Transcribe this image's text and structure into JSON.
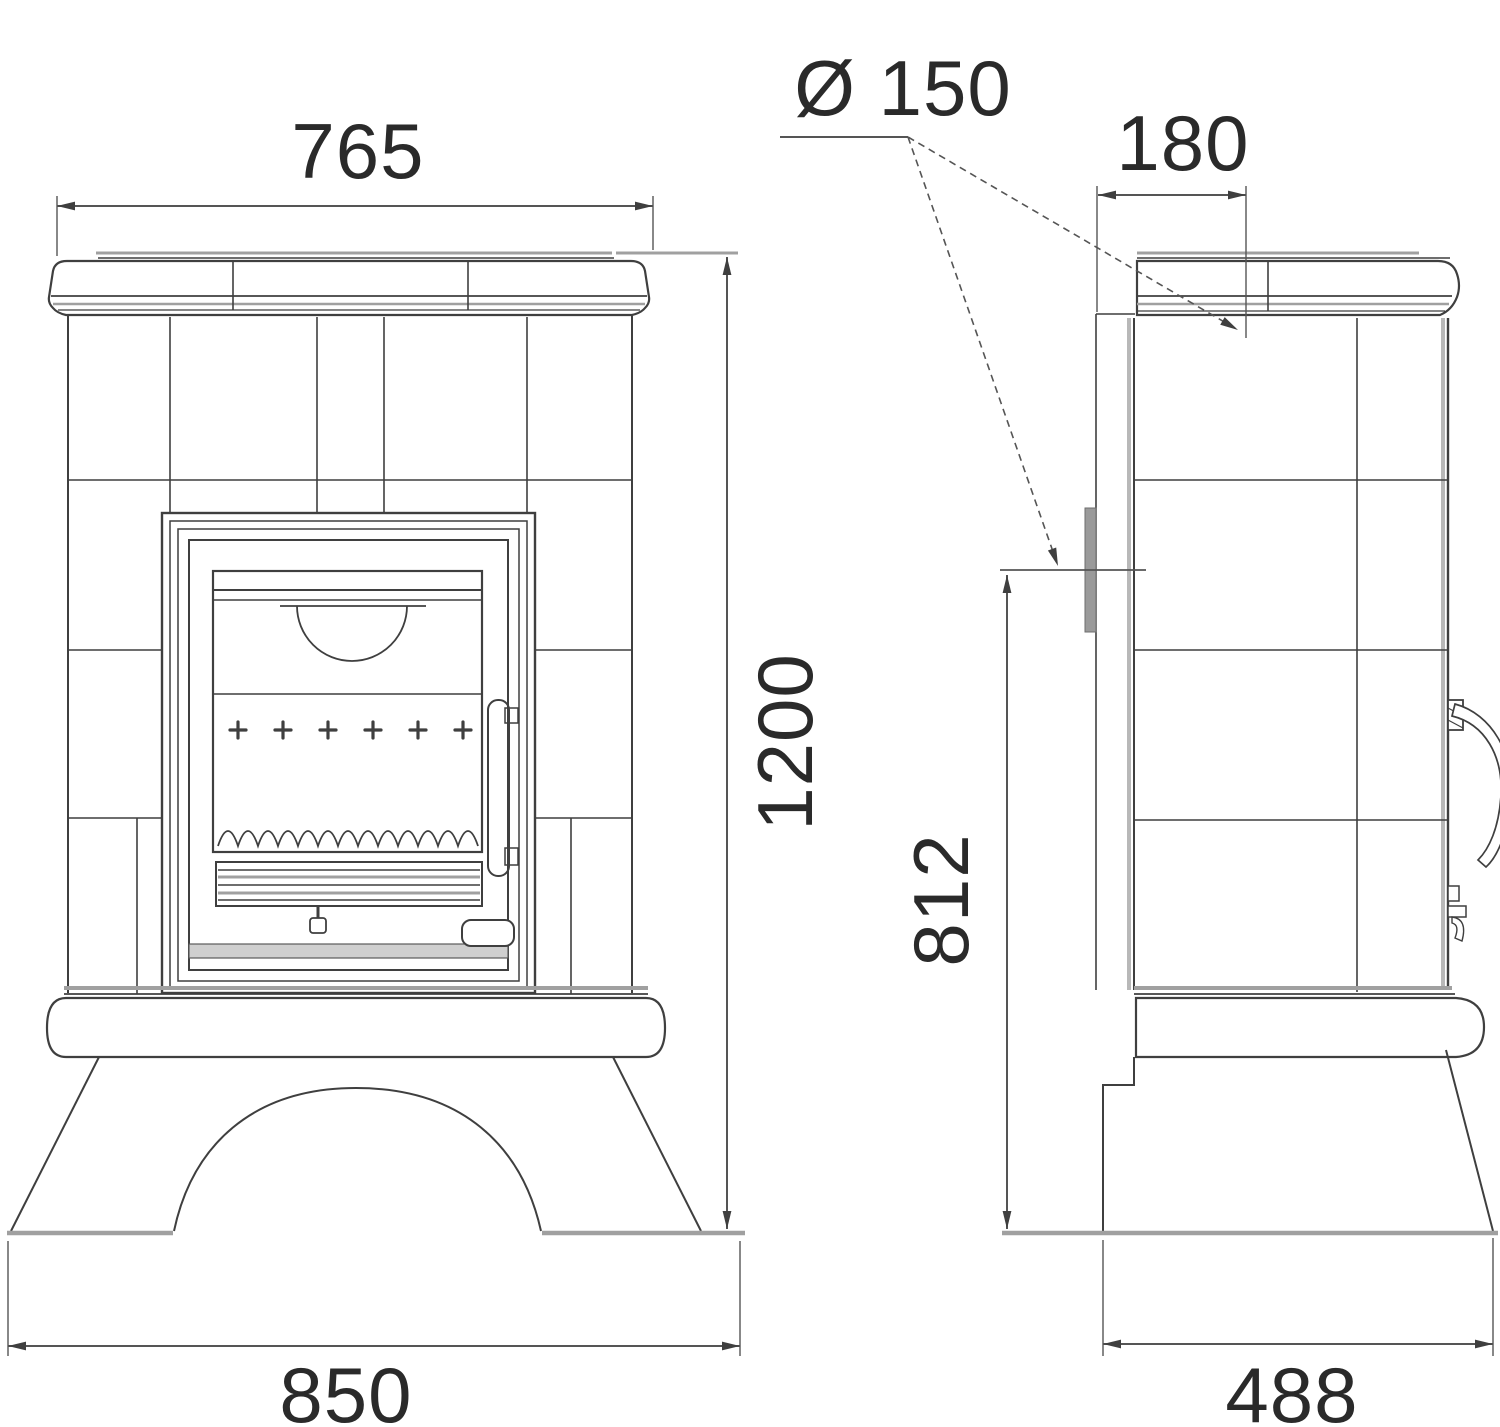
{
  "drawing": {
    "background": "#ffffff",
    "line_color": "#3f3f3f",
    "soft_line_color": "#a0a0a0",
    "dimension_color": "#555555",
    "label_color": "#2a2a2a",
    "labels": {
      "top_width": "765",
      "flue_diameter": "Ø 150",
      "flue_center_offset": "180",
      "overall_height": "1200",
      "rear_flue_height": "812",
      "base_width": "850",
      "base_depth": "488"
    }
  }
}
